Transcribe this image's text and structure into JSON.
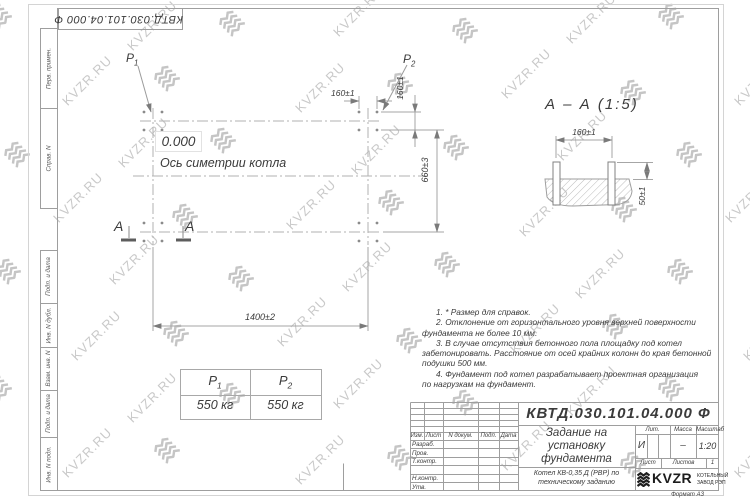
{
  "watermark": {
    "text": "KVZR.RU"
  },
  "stamp_top": {
    "text": "КВТД.030.101.04.000 Ф"
  },
  "margin": {
    "col1": "Перв. примен.",
    "col2": "Справ. N",
    "col3": "Подп. и дата",
    "col4": "Инв. N дубл.",
    "col5": "Взам. инв. N",
    "col6": "Подп. и дата",
    "col7": "Инв. N подл."
  },
  "plan": {
    "load1": {
      "base": "P",
      "sub": "1"
    },
    "load2": {
      "base": "P",
      "sub": "2"
    },
    "elevation": "0.000",
    "axis_label": "Ось симетрии котла",
    "dim_width": "1400±2",
    "dim_height": "660±3",
    "dim_160_h": "160±1",
    "dim_160_v": "160±1",
    "section_letter_left": "A",
    "section_letter_right": "A"
  },
  "section": {
    "title": "А – А (1:5)",
    "dim_spacing": "160±1",
    "dim_height": "50±1"
  },
  "load_table": {
    "col1": {
      "base": "P",
      "sub": "1"
    },
    "col2": {
      "base": "P",
      "sub": "2"
    },
    "val1": "550 кг",
    "val2": "550 кг"
  },
  "notes": {
    "line1": "1. * Размер для справок.",
    "line2": "2. Отклонение от горизонтального уровня верхней поверхности",
    "line3": "фундамента не более 10 мм.",
    "line4": "3. В случае отсутствия бетонного пола площадку под котел",
    "line5": "забетонировать. Расстояние от осей крайних колонн до края бетонной",
    "line6": "подушки 500 мм.",
    "line7": "4. Фундамент под котел разрабатывает проектная организация",
    "line8": "по нагрузкам на фундамент."
  },
  "title_block": {
    "doc_number": "КВТД.030.101.04.000 Ф",
    "title_line1": "Задание на",
    "title_line2": "установку",
    "title_line3": "фундамента",
    "subtitle_line1": "Котел КВ-0,35 Д (РВР) по",
    "subtitle_line2": "техническому заданию",
    "hdr_izm": "Изм.",
    "hdr_list": "Лист",
    "hdr_doc": "N докум.",
    "hdr_podp": "Подп.",
    "hdr_data": "Дата",
    "row_razrab": "Разраб.",
    "row_prov": "Пров.",
    "row_tkontr": "Т.контр.",
    "row_nkontr": "Н.контр.",
    "row_utv": "Утв.",
    "lit_label": "Лит.",
    "mass_label": "Масса",
    "scale_label": "Масштаб",
    "lit_value": "И",
    "mass_value": "–",
    "scale_value": "1:20",
    "sheet_label": "Лист",
    "sheets_label": "Листов",
    "sheets_value": "1",
    "logo_text": "KVZR",
    "logo_caption1": "КОТЕЛЬНЫЙ",
    "logo_caption2": "ЗАВОД РЭП",
    "format_label": "Формат А3"
  }
}
